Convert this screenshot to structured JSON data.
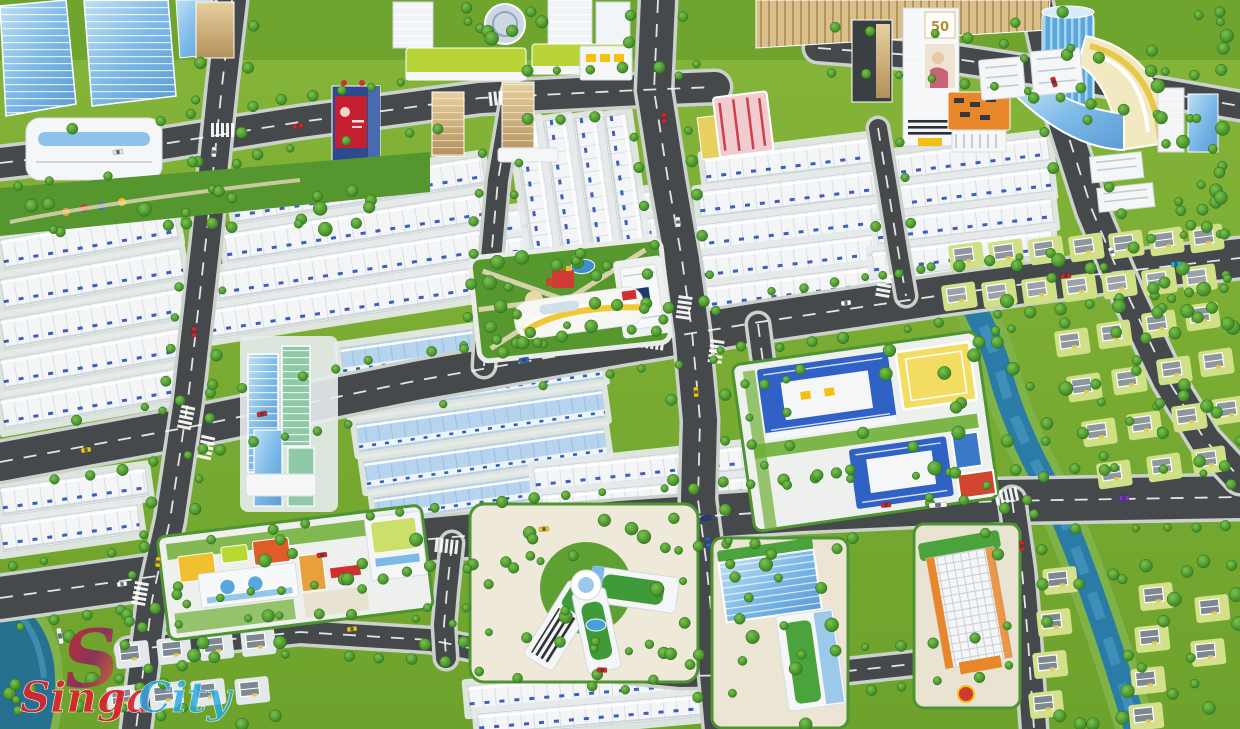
{
  "watermark": {
    "logo_letter": "S",
    "brand_part1": "Singa",
    "brand_part2": "City",
    "part1_color": "#d8232a",
    "part2_color": "#2ba9e0",
    "logo_gradient": [
      "#d8232a",
      "#8c2a5e",
      "#e87f2a"
    ]
  },
  "signs": {
    "tower_billboard_sign": "50"
  },
  "palette": {
    "grass": "#79ab31",
    "park_green": "#57982e",
    "road_asphalt": "#45494c",
    "road_line": "#ffffff",
    "curb": "#cbd1cb",
    "row_house_white": "#f3f5f7",
    "row_house_blue_roof": "#b7d4ee",
    "window_blue": "#3a5fc0",
    "tree_green": "#3f8f27",
    "canal_blue": "#2a7ba6",
    "school_roof_blue": "#2f62c4",
    "sports_field_yellow": "#f3dc62",
    "court_red": "#d2452f",
    "glass_blue": "#7db9e8",
    "orange_building": "#e8872a",
    "gold_tower": "#c9a05e",
    "villa_roof_gray": "#8e979e",
    "kindergarten_yellow": "#f0c030",
    "mall_cream": "#f2e9c0",
    "playground_red": "#d23a35"
  },
  "depicted_features": [
    "high-rise-glass-towers-northwest",
    "shophouse-row-blocks",
    "blue-roof-townhouse-rows",
    "central-park-with-playground",
    "school-campus-blue-roofs",
    "kindergarten-colorful",
    "y-shaped-office-building",
    "orange-apartment-tower",
    "curved-shopping-mall",
    "villa-district-with-canal",
    "billboard-advertising-towers",
    "road-network-with-cars"
  ]
}
